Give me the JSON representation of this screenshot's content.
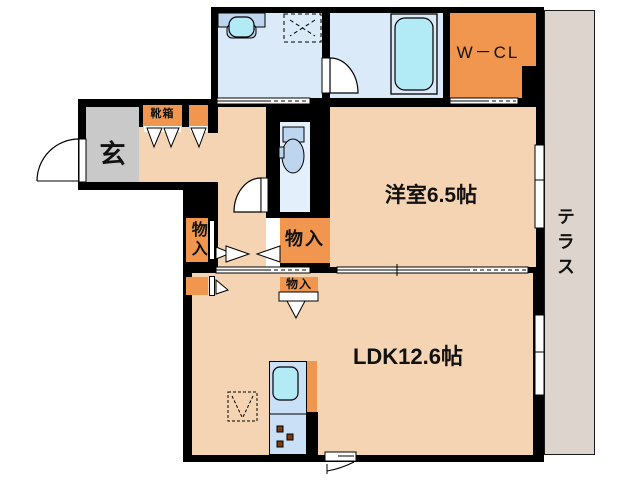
{
  "plan_title": "1LDK floor plan",
  "labels": {
    "genkan": "玄",
    "shoebox": "靴箱",
    "wcl": "W－CL",
    "western_room": "洋室6.5帖",
    "ldk": "LDK12.6帖",
    "terrace": "テラス",
    "storage_tall": "物入",
    "storage_right": "物入",
    "storage_small": "物入"
  },
  "colors": {
    "wall": "#000000",
    "floor_peach": "#f4d4b2",
    "closet_orange": "#f0964e",
    "wet_room_blue": "#daeaf9",
    "toilet_room_blue": "#e3effb",
    "fixture_blue": "#bdd5ef",
    "water_cyan": "#b2ebf5",
    "kitchen_blue": "#c9e0f6",
    "genkan_gray": "#c9c9c9",
    "terrace_beige": "#ddd5cd",
    "burner_brown": "#7a3c10",
    "outline": "#000000"
  }
}
